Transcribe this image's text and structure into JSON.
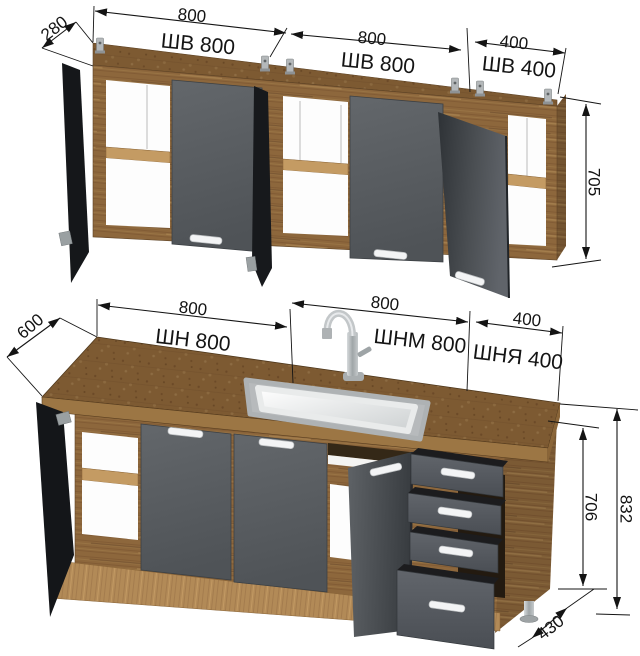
{
  "upper_row": {
    "depth_label": "280",
    "height_label": "705",
    "cabinets": [
      {
        "width_label": "800",
        "name_label": "ШВ 800"
      },
      {
        "width_label": "800",
        "name_label": "ШВ 800"
      },
      {
        "width_label": "400",
        "name_label": "ШВ 400"
      }
    ]
  },
  "lower_row": {
    "depth_label": "600",
    "cabinet_height_label": "706",
    "total_height_label": "832",
    "floor_depth_label": "430",
    "cabinets": [
      {
        "width_label": "800",
        "name_label": "ШН 800"
      },
      {
        "width_label": "800",
        "name_label": "ШНМ 800"
      },
      {
        "width_label": "400",
        "name_label": "ШНЯ 400"
      }
    ]
  },
  "colors": {
    "wood_front": "#8d673c",
    "wood_top": "#7d5a32",
    "wood_plinth": "#b28a57",
    "facade_gray": "#5b5f63",
    "facade_dark": "#17191c",
    "dimension": "#141414",
    "background": "#ffffff"
  }
}
